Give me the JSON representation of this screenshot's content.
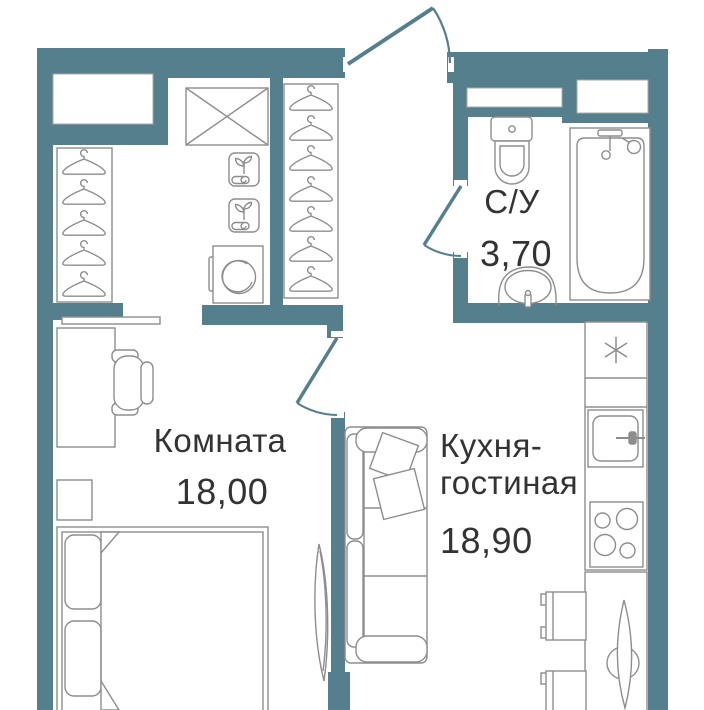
{
  "meta": {
    "type": "apartment-floor-plan"
  },
  "colors": {
    "wall": "#567f8e",
    "furniture_line": "#8d8d8d",
    "text": "#333333",
    "background": "#ffffff"
  },
  "rooms": [
    {
      "key": "bedroom",
      "label": "Комната",
      "area": "18,00"
    },
    {
      "key": "kitchen_living",
      "label_line1": "Кухня-",
      "label_line2": "гостиная",
      "area": "18,90"
    },
    {
      "key": "bathroom",
      "label": "С/У",
      "area": "3,70"
    }
  ],
  "fixtures": {
    "wardrobe": {
      "hanger_racks": 2,
      "hangers_left": 5,
      "hangers_right": 7,
      "items": [
        "crossed-cabinet",
        "shelf-with-plant",
        "shelf-with-plant",
        "washing-machine"
      ]
    },
    "bathroom": [
      "toilet",
      "wash-basin",
      "bathtub"
    ],
    "bedroom": [
      "shelf",
      "desk",
      "office-chair",
      "nightstand",
      "double-bed",
      "leaning-mirror"
    ],
    "kitchen_living": [
      "sofa",
      "throw-pillows",
      "fridge",
      "kitchen-sink",
      "stove-4-burners",
      "dining-table",
      "chair",
      "chair"
    ],
    "doors": [
      "entrance-door",
      "bathroom-door",
      "bedroom-door"
    ]
  }
}
